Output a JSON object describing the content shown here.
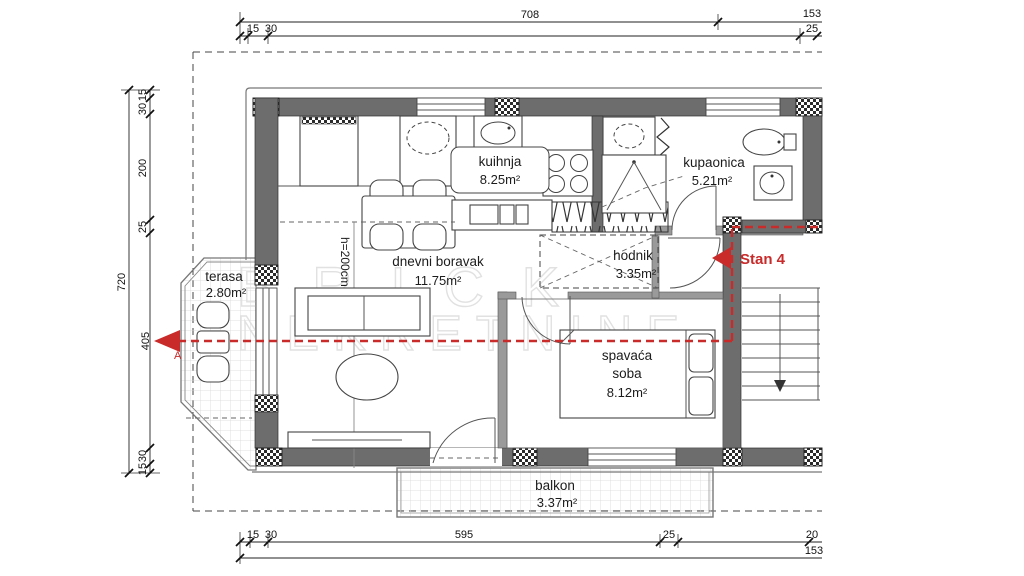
{
  "title": "Stan 4 floor plan",
  "colors": {
    "wall": "#6d6d6d",
    "line": "#222222",
    "red": "#c92a2a",
    "light_wall": "#9a9a9a",
    "watermark": "#e0e0e0"
  },
  "rooms": [
    {
      "name": "kuihnja",
      "area": "8.25m²"
    },
    {
      "name": "kupaonica",
      "area": "5.21m²"
    },
    {
      "name": "dnevni boravak",
      "area": "11.75m²"
    },
    {
      "name": "hodnik",
      "area": "3.35m²"
    },
    {
      "name": "terasa",
      "area": "2.80m²"
    },
    {
      "name": "spavaća soba",
      "line1": "spavaća",
      "line2": "soba",
      "area": "8.12m²"
    },
    {
      "name": "balkon",
      "area": "3.37m²"
    }
  ],
  "annotations": {
    "unit": "Stan 4",
    "section": "A",
    "height": "h=200cm"
  },
  "dimensions": {
    "top": [
      "708",
      "153",
      "15",
      "30",
      "25"
    ],
    "left": [
      "720",
      "15",
      "30",
      "200",
      "25",
      "405",
      "30",
      "15"
    ],
    "bottom": [
      "15",
      "30",
      "595",
      "25",
      "20",
      "153"
    ]
  },
  "watermark": {
    "line1": "BRICK",
    "line2": "NEKRETNINE"
  }
}
